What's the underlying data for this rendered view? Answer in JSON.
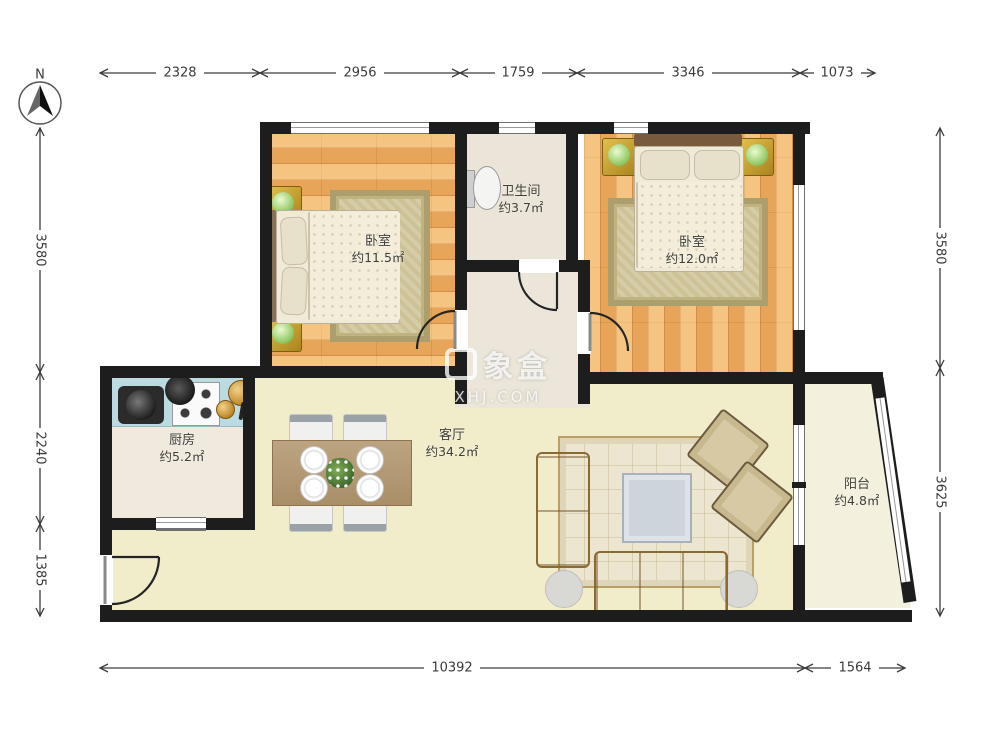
{
  "compass": {
    "label": "N"
  },
  "watermark": {
    "brand": "象盒",
    "site": "XHJ.COM"
  },
  "rooms": [
    {
      "id": "bedroom-left",
      "name": "卧室",
      "area": "约11.5㎡"
    },
    {
      "id": "bathroom",
      "name": "卫生间",
      "area": "约3.7㎡"
    },
    {
      "id": "bedroom-right",
      "name": "卧室",
      "area": "约12.0㎡"
    },
    {
      "id": "kitchen",
      "name": "厨房",
      "area": "约5.2㎡"
    },
    {
      "id": "living-room",
      "name": "客厅",
      "area": "约34.2㎡"
    },
    {
      "id": "balcony",
      "name": "阳台",
      "area": "约4.8㎡"
    }
  ],
  "dimensions": {
    "top": [
      "2328",
      "2956",
      "1759",
      "3346",
      "1073"
    ],
    "left": [
      "3580",
      "2240",
      "1385"
    ],
    "right": [
      "3580",
      "3625"
    ],
    "bottom": [
      "10392",
      "1564"
    ]
  },
  "colors": {
    "wall": "#1d1d1d",
    "wood_floor": "#edb166",
    "living_floor": "#f1ecca",
    "kitchen_counter": "#bcdbe0",
    "dim_line": "#3c3c3c"
  }
}
